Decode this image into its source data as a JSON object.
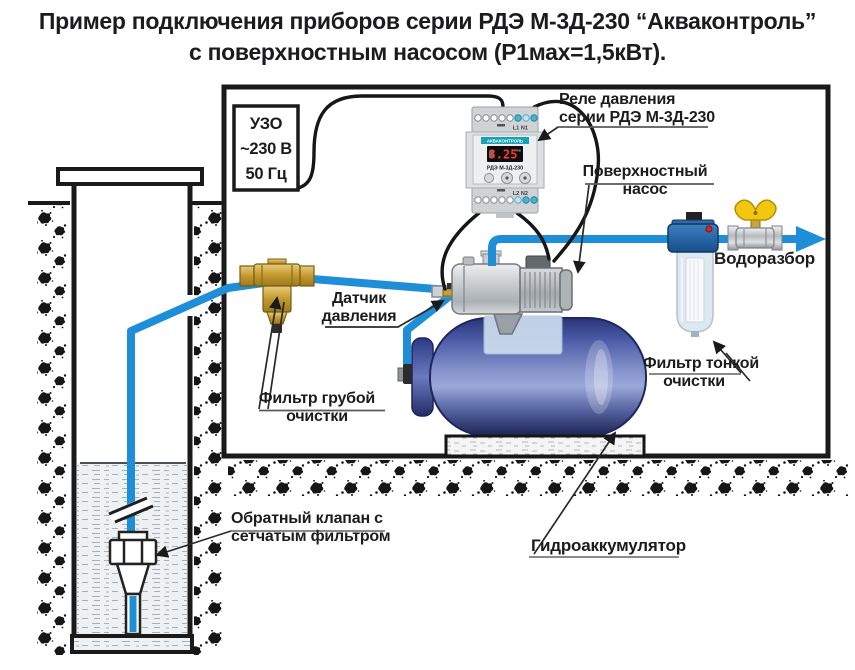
{
  "title": {
    "line1": "Пример подключения приборов серии РДЭ М-3Д-230 “Акваконтроль”",
    "line2": "с поверхностным насосом (Р1мах=1,5кВт)."
  },
  "labels": {
    "uzo": {
      "line1": "УЗО",
      "line2": "~230 В",
      "line3": "50 Гц"
    },
    "relay": {
      "line1": "Реле давления",
      "line2": "серии РДЭ М-3Д-230"
    },
    "surface_pump": {
      "line1": "Поверхностный",
      "line2": "насос"
    },
    "tap": "Водоразбор",
    "pressure_sensor": {
      "line1": "Датчик",
      "line2": "давления"
    },
    "coarse_filter": {
      "line1": "Фильтр грубой",
      "line2": "очистки"
    },
    "fine_filter": {
      "line1": "Фильтр тонкой",
      "line2": "очистки"
    },
    "check_valve": {
      "line1": "Обратный клапан с",
      "line2": "сетчатым фильтром"
    },
    "accumulator": "Гидроаккумулятор"
  },
  "relay_device": {
    "brand_strip": "АКВАКОНТРОЛЬ",
    "display_value": "3.25",
    "display_unit": "bar",
    "model": "РДЭ М-3Д-230",
    "terminals_top": "L1  N1",
    "terminals_bottom": "L2  N2"
  },
  "colors": {
    "pipe": "#1e8ed6",
    "wire": "#161616",
    "tank_body": "#3b4a9c",
    "valve_handle": "#f2c70e",
    "display_digits": "#ff3b30",
    "brand_teal": "#17a2b4"
  }
}
